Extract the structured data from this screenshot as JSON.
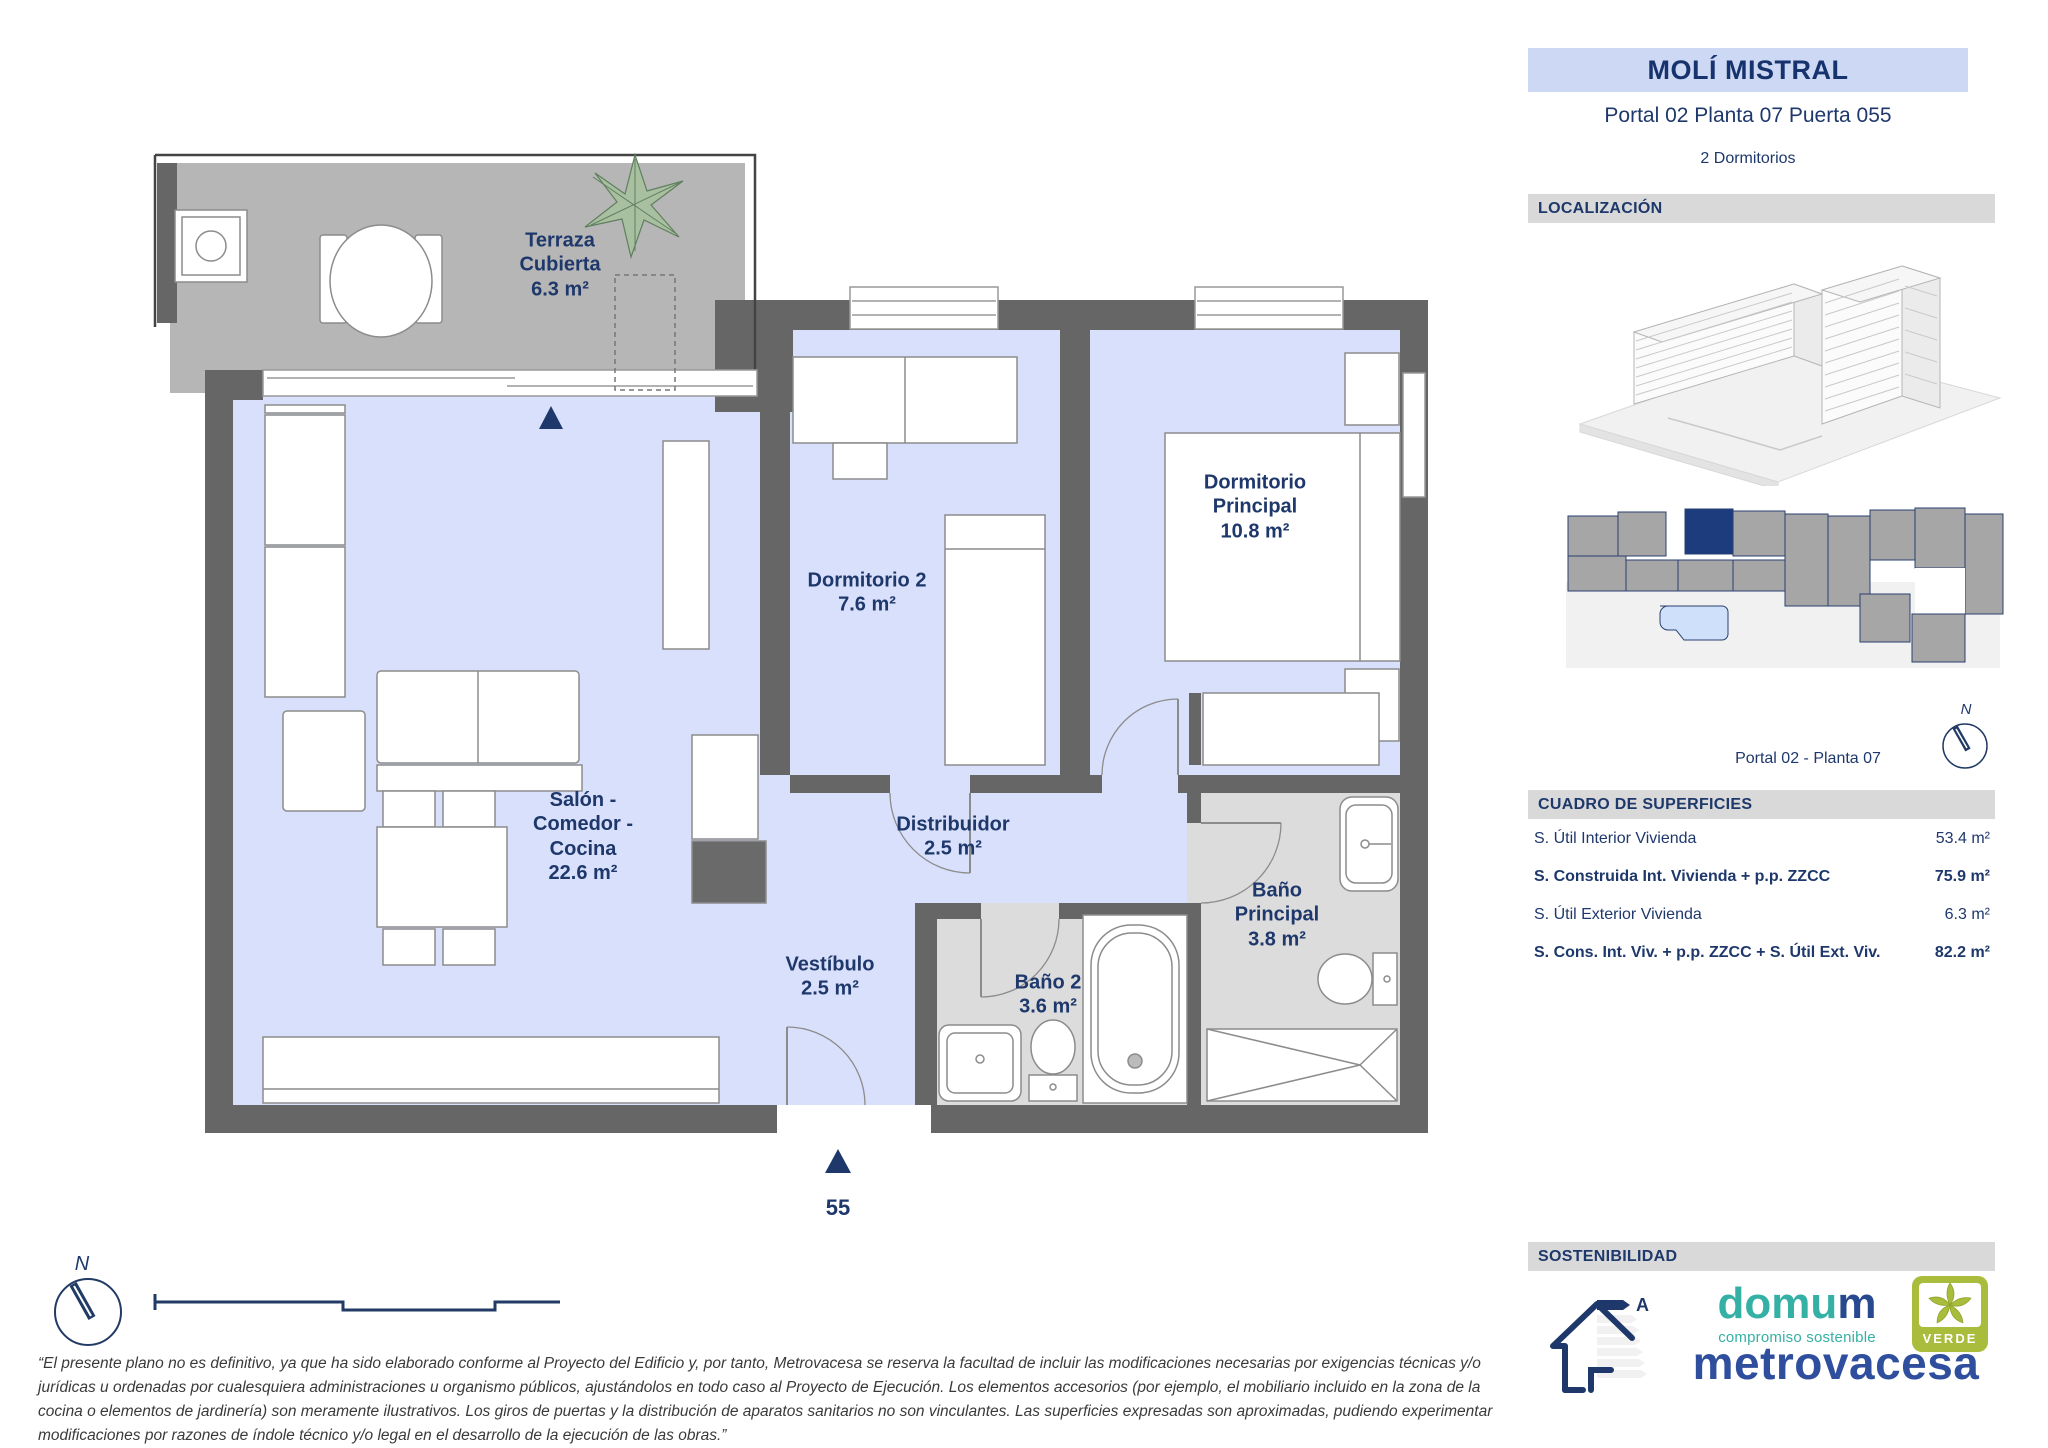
{
  "header": {
    "title": "MOLÍ MISTRAL",
    "subtitle": "Portal 02 Planta 07 Puerta 055",
    "rooms_count": "2 Dormitorios"
  },
  "sections": {
    "localization": "LOCALIZACIÓN",
    "surfaces": "CUADRO DE SUPERFICIES",
    "sustainability": "SOSTENIBILIDAD"
  },
  "localization": {
    "caption": "Portal 02 - Planta 07",
    "compass": "N"
  },
  "surfaces_rows": [
    {
      "label": "S. Útil Interior Vivienda",
      "value": "53.4 m²"
    },
    {
      "label": "S. Construida Int. Vivienda + p.p. ZZCC",
      "value": "75.9 m²"
    },
    {
      "label": "S. Útil Exterior Vivienda",
      "value": "6.3 m²"
    },
    {
      "label": "S. Cons. Int. Viv. + p.p. ZZCC + S. Útil Ext. Viv.",
      "value": "82.2 m²"
    }
  ],
  "plan": {
    "compass": "N",
    "entry_number": "55",
    "rooms": [
      {
        "name": "Terraza Cubierta",
        "area": "6.3 m²"
      },
      {
        "name": "Dormitorio 2",
        "area": "7.6 m²"
      },
      {
        "name": "Dormitorio Principal",
        "area": "10.8 m²"
      },
      {
        "name": "Salón - Comedor - Cocina",
        "area": "22.6 m²"
      },
      {
        "name": "Distribuidor",
        "area": "2.5 m²"
      },
      {
        "name": "Vestíbulo",
        "area": "2.5 m²"
      },
      {
        "name": "Baño 2",
        "area": "3.6 m²"
      },
      {
        "name": "Baño Principal",
        "area": "3.8 m²"
      }
    ]
  },
  "sustainability": {
    "energy_rating": "A",
    "domum_teal": "domu",
    "domum_navy": "m",
    "domum_tagline": "compromiso sostenible",
    "verde": "VERDE",
    "developer": "metrovacesa"
  },
  "disclaimer": "“El presente plano no es definitivo, ya que ha sido elaborado conforme al Proyecto del Edificio y, por tanto, Metrovacesa se reserva la facultad de incluir las modificaciones necesarias por exigencias técnicas y/o jurídicas u ordenadas por cualesquiera administraciones u organismo públicos, ajustándolos en todo caso al Proyecto de Ejecución. Los elementos accesorios (por ejemplo, el mobiliario incluido en la zona de la cocina o elementos de jardinería) son meramente ilustrativos. Los giros de puertas y la distribución de aparatos sanitarios no son vinculantes. Las superficies expresadas son aproximadas, pudiendo experimentar modificaciones por razones de índole técnico y/o legal en el desarrollo de la ejecución de las obras.”",
  "colors": {
    "accent_navy": "#1e386b",
    "floor_blue": "#d9e0fb",
    "terrace_gray": "#b6b6b6",
    "bath_gray": "#dcdcdc",
    "wall_gray": "#666666",
    "highlight_unit": "#1c3c7e",
    "domum_teal": "#35b0a4",
    "metrovacesa_blue": "#2f4f9e",
    "verde_green": "#a9bc3b"
  }
}
